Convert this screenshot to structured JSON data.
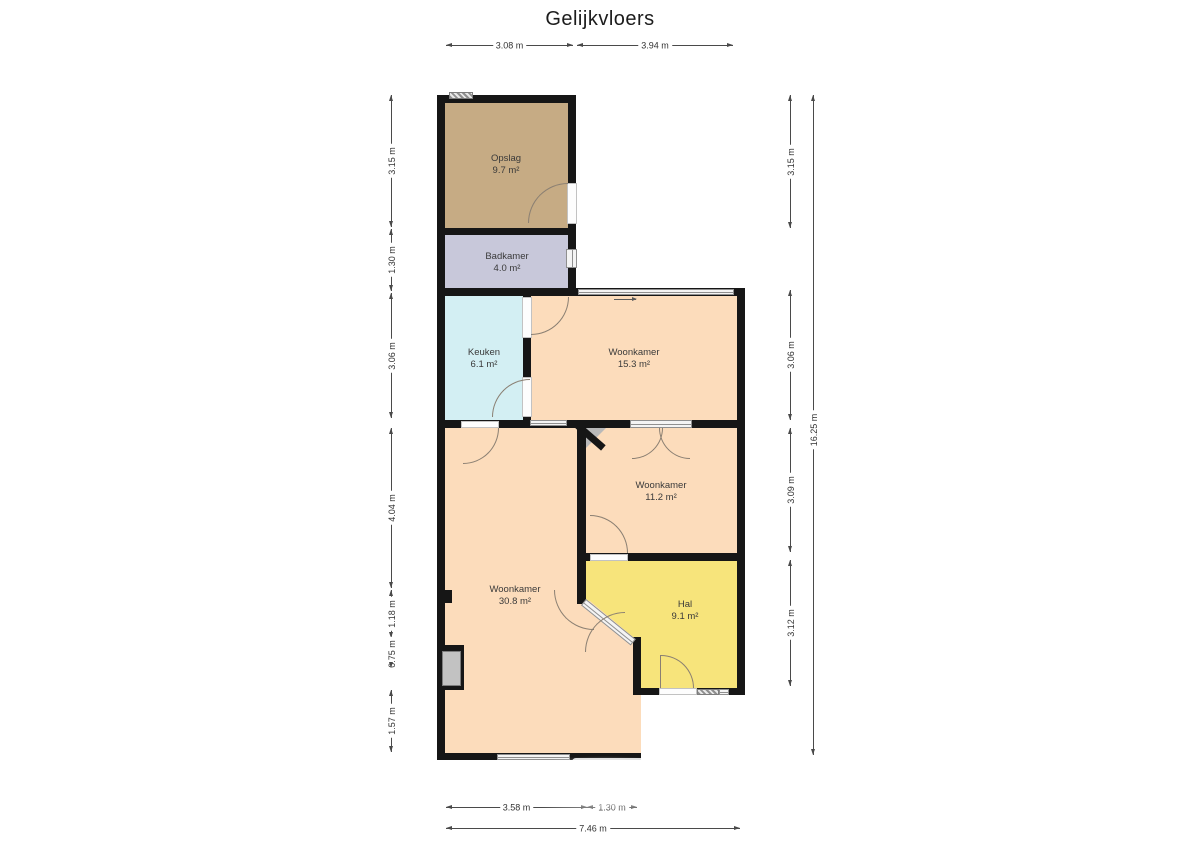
{
  "title": "Gelijkvloers",
  "rooms": [
    {
      "id": "opslag",
      "name": "Opslag",
      "area": "9.7 m²",
      "color": "#c6ab84"
    },
    {
      "id": "badkamer",
      "name": "Badkamer",
      "area": "4.0 m²",
      "color": "#c8c8da"
    },
    {
      "id": "keuken",
      "name": "Keuken",
      "area": "6.1 m²",
      "color": "#d3eff3"
    },
    {
      "id": "woonkamer-15",
      "name": "Woonkamer",
      "area": "15.3 m²",
      "color": "#fcdcbb"
    },
    {
      "id": "woonkamer-11",
      "name": "Woonkamer",
      "area": "11.2 m²",
      "color": "#fcdcbb"
    },
    {
      "id": "woonkamer-30",
      "name": "Woonkamer",
      "area": "30.8 m²",
      "color": "#fcdcbb"
    },
    {
      "id": "hal",
      "name": "Hal",
      "area": "9.1 m²",
      "color": "#f7e47b"
    }
  ],
  "dimensions": {
    "top": [
      "3.08 m",
      "3.94 m"
    ],
    "left": [
      "3.15 m",
      "1.30 m",
      "3.06 m",
      "4.04 m",
      "1.18 m",
      "0.75 m",
      "1.57 m"
    ],
    "right": [
      "3.15 m",
      "3.06 m",
      "3.09 m",
      "3.12 m"
    ],
    "right_total": "16.25 m",
    "bottom": [
      "3.58 m",
      "1.30 m"
    ],
    "bottom_total": "7.46 m"
  },
  "colors": {
    "wall": "#161616",
    "window": "#f4f4f4",
    "dimension_text": "#333333"
  }
}
